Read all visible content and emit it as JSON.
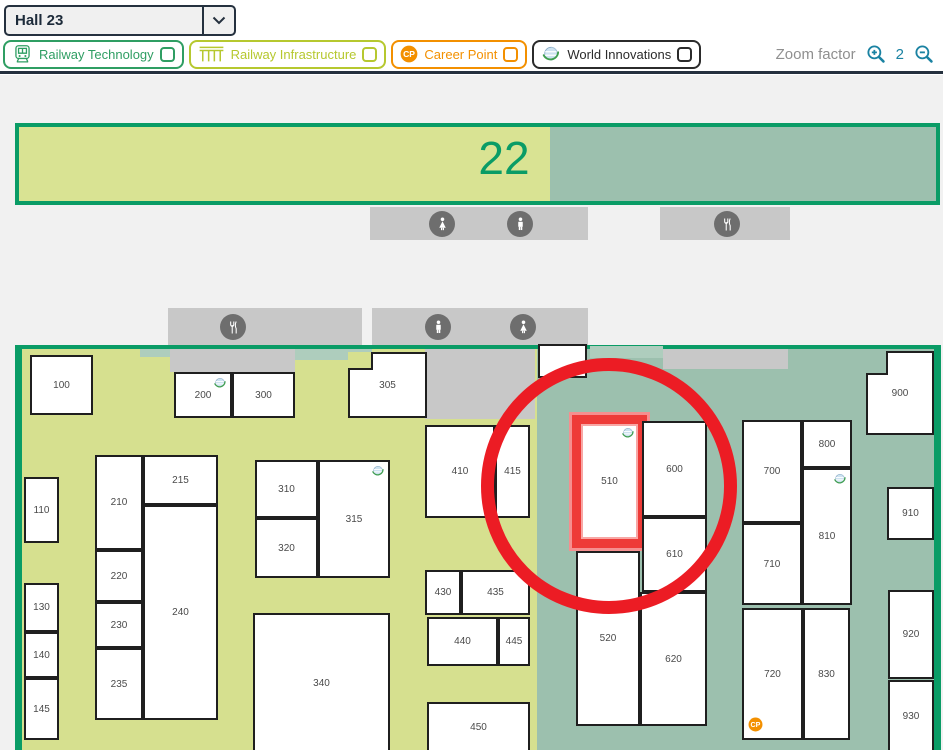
{
  "header": {
    "hall_select": {
      "value": "Hall 23"
    },
    "legend": [
      {
        "label": "Railway Technology",
        "icon": "train-icon",
        "color": "#2f9e63"
      },
      {
        "label": "Railway Infrastructure",
        "icon": "bridge-icon",
        "color": "#b6c82f"
      },
      {
        "label": "Career Point",
        "icon": "career-point-icon",
        "color": "#f39000"
      },
      {
        "label": "World Innovations",
        "icon": "globe-icon",
        "color": "#2b2b2b"
      }
    ],
    "zoom_control": {
      "label": "Zoom factor",
      "value": "2",
      "color": "#1a82a2"
    }
  },
  "map": {
    "background": "#f1f1f1",
    "colors": {
      "wall": "#0a9c66",
      "floor_yellow": "#d6e08f",
      "floor_teal": "#9cc0ae",
      "floor_teal_light": "#aecdbd",
      "strip_gray": "#c8c8c8",
      "amenity_circle": "#6e6e6e",
      "booth_border": "#1f1f1f",
      "booth_label": "#4a4a4a",
      "highlight_red": "#ec1c24",
      "highlight_red_soft": "#f58f8f"
    },
    "hall22": {
      "label": "22",
      "x": 15,
      "y": 123,
      "w": 925,
      "h": 82,
      "yellow_w": 531
    },
    "hall23": {
      "x": 15,
      "y": 345,
      "w": 926,
      "h": 405,
      "wall": 7,
      "teal_from": 537
    },
    "strips": [
      {
        "x": 370,
        "y": 207,
        "w": 218,
        "h": 33
      },
      {
        "x": 660,
        "y": 207,
        "w": 130,
        "h": 33
      },
      {
        "x": 168,
        "y": 308,
        "w": 194,
        "h": 37
      },
      {
        "x": 372,
        "y": 308,
        "w": 216,
        "h": 37
      },
      {
        "x": 170,
        "y": 349,
        "w": 125,
        "h": 23
      },
      {
        "x": 425,
        "y": 349,
        "w": 110,
        "h": 70
      },
      {
        "x": 663,
        "y": 349,
        "w": 125,
        "h": 20
      }
    ],
    "teal_patches": [
      {
        "x": 140,
        "y": 349,
        "w": 30,
        "h": 8
      },
      {
        "x": 295,
        "y": 349,
        "w": 77,
        "h": 11
      },
      {
        "x": 590,
        "y": 346,
        "w": 73,
        "h": 12
      }
    ],
    "amenities": [
      {
        "icon": "restroom-woman-icon",
        "x": 442,
        "y": 224
      },
      {
        "icon": "restroom-man-icon",
        "x": 520,
        "y": 224
      },
      {
        "icon": "restaurant-icon",
        "x": 727,
        "y": 224
      },
      {
        "icon": "restaurant-icon",
        "x": 233,
        "y": 327
      },
      {
        "icon": "restroom-man-icon",
        "x": 438,
        "y": 327
      },
      {
        "icon": "restroom-woman-icon",
        "x": 523,
        "y": 327
      }
    ],
    "booths": [
      {
        "label": "100",
        "x": 30,
        "y": 355,
        "w": 63,
        "h": 60
      },
      {
        "label": "200",
        "x": 174,
        "y": 372,
        "w": 58,
        "h": 46,
        "globe": true
      },
      {
        "label": "300",
        "x": 232,
        "y": 372,
        "w": 63,
        "h": 46
      },
      {
        "label": "305",
        "x": 348,
        "y": 352,
        "w": 79,
        "h": 66,
        "notch": {
          "w": 25,
          "h": 18,
          "zone": "yellow"
        }
      },
      {
        "label": "110",
        "x": 24,
        "y": 477,
        "w": 35,
        "h": 66
      },
      {
        "label": "130",
        "x": 24,
        "y": 583,
        "w": 35,
        "h": 49
      },
      {
        "label": "140",
        "x": 24,
        "y": 632,
        "w": 35,
        "h": 46
      },
      {
        "label": "145",
        "x": 24,
        "y": 678,
        "w": 35,
        "h": 62
      },
      {
        "label": "210",
        "x": 95,
        "y": 455,
        "w": 48,
        "h": 95
      },
      {
        "label": "215",
        "x": 143,
        "y": 455,
        "w": 75,
        "h": 50
      },
      {
        "label": "220",
        "x": 95,
        "y": 550,
        "w": 48,
        "h": 52
      },
      {
        "label": "230",
        "x": 95,
        "y": 602,
        "w": 48,
        "h": 46
      },
      {
        "label": "235",
        "x": 95,
        "y": 648,
        "w": 48,
        "h": 72
      },
      {
        "label": "240",
        "x": 143,
        "y": 505,
        "w": 75,
        "h": 215
      },
      {
        "label": "310",
        "x": 255,
        "y": 460,
        "w": 63,
        "h": 58
      },
      {
        "label": "315",
        "x": 318,
        "y": 460,
        "w": 72,
        "h": 118,
        "globe": true
      },
      {
        "label": "320",
        "x": 255,
        "y": 518,
        "w": 63,
        "h": 60
      },
      {
        "label": "340",
        "x": 253,
        "y": 613,
        "w": 137,
        "h": 140
      },
      {
        "label": "410",
        "x": 425,
        "y": 425,
        "w": 70,
        "h": 93
      },
      {
        "label": "415",
        "x": 495,
        "y": 425,
        "w": 35,
        "h": 93
      },
      {
        "label": "430",
        "x": 425,
        "y": 570,
        "w": 36,
        "h": 45
      },
      {
        "label": "435",
        "x": 461,
        "y": 570,
        "w": 69,
        "h": 45
      },
      {
        "label": "440",
        "x": 427,
        "y": 617,
        "w": 71,
        "h": 49
      },
      {
        "label": "445",
        "x": 498,
        "y": 617,
        "w": 32,
        "h": 49
      },
      {
        "label": "450",
        "x": 427,
        "y": 702,
        "w": 103,
        "h": 51
      },
      {
        "label": "",
        "x": 538,
        "y": 344,
        "w": 49,
        "h": 34
      },
      {
        "label": "510",
        "x": 572,
        "y": 415,
        "w": 75,
        "h": 133,
        "globe": true,
        "highlighted": true
      },
      {
        "label": "520",
        "x": 576,
        "y": 551,
        "w": 64,
        "h": 175
      },
      {
        "label": "600",
        "x": 642,
        "y": 421,
        "w": 65,
        "h": 96
      },
      {
        "label": "610",
        "x": 642,
        "y": 517,
        "w": 65,
        "h": 75
      },
      {
        "label": "620",
        "x": 640,
        "y": 592,
        "w": 67,
        "h": 134
      },
      {
        "label": "700",
        "x": 742,
        "y": 420,
        "w": 60,
        "h": 103
      },
      {
        "label": "710",
        "x": 742,
        "y": 523,
        "w": 60,
        "h": 82
      },
      {
        "label": "720",
        "x": 742,
        "y": 608,
        "w": 61,
        "h": 132,
        "career_point": true
      },
      {
        "label": "800",
        "x": 802,
        "y": 420,
        "w": 50,
        "h": 48
      },
      {
        "label": "810",
        "x": 802,
        "y": 468,
        "w": 50,
        "h": 137,
        "globe": true
      },
      {
        "label": "830",
        "x": 803,
        "y": 608,
        "w": 47,
        "h": 132
      },
      {
        "label": "900",
        "x": 866,
        "y": 351,
        "w": 68,
        "h": 84,
        "notch": {
          "w": 22,
          "h": 24,
          "zone": "teal"
        }
      },
      {
        "label": "910",
        "x": 887,
        "y": 487,
        "w": 47,
        "h": 53
      },
      {
        "label": "920",
        "x": 888,
        "y": 590,
        "w": 46,
        "h": 89
      },
      {
        "label": "930",
        "x": 888,
        "y": 680,
        "w": 46,
        "h": 72
      }
    ],
    "highlight_circle": {
      "cx": 609,
      "cy": 486,
      "r": 128,
      "stroke": 13
    }
  }
}
